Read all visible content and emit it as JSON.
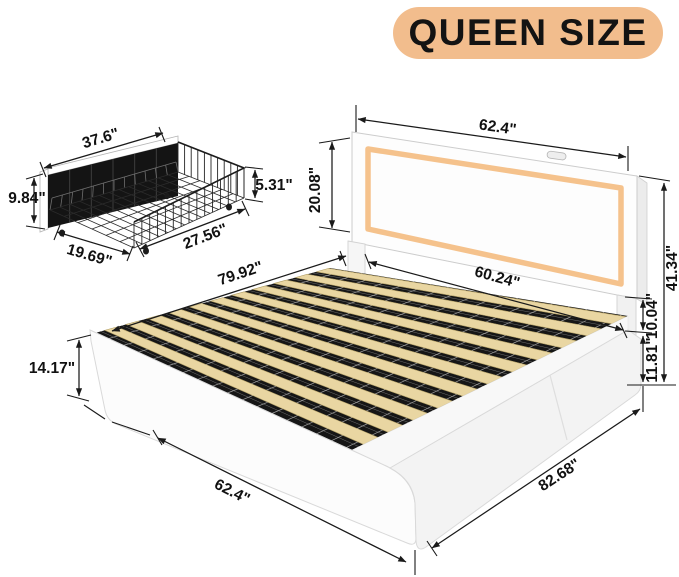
{
  "badge": {
    "label": "QUEEN SIZE",
    "bg_color": "#f2bd8d",
    "text_color": "#131313"
  },
  "drawer": {
    "name": "under-bed wire storage drawer",
    "dims": {
      "width": "37.6\"",
      "front_height": "9.84\"",
      "basket_height": "5.31\"",
      "length": "27.56\"",
      "depth": "19.69\""
    }
  },
  "bed": {
    "name": "upholstered platform bed with LED headboard and slat deck",
    "dims": {
      "headboard_width": "62.4\"",
      "headboard_panel_height": "20.08\"",
      "total_height": "41.34\"",
      "headboard_clearance": "10.04\"",
      "side_rail_height": "11.81\"",
      "slat_area_width": "60.24\"",
      "inner_length": "79.92\"",
      "footboard_height": "14.17\"",
      "overall_width": "62.4\"",
      "overall_length": "82.68\""
    }
  },
  "colors": {
    "badge_bg": "#f2bd8d",
    "led_strip": "#f5c28c",
    "slat_wood": "#e9d6a2",
    "frame_white": "#fbfbfb",
    "wire_black": "#1a1a1a"
  }
}
